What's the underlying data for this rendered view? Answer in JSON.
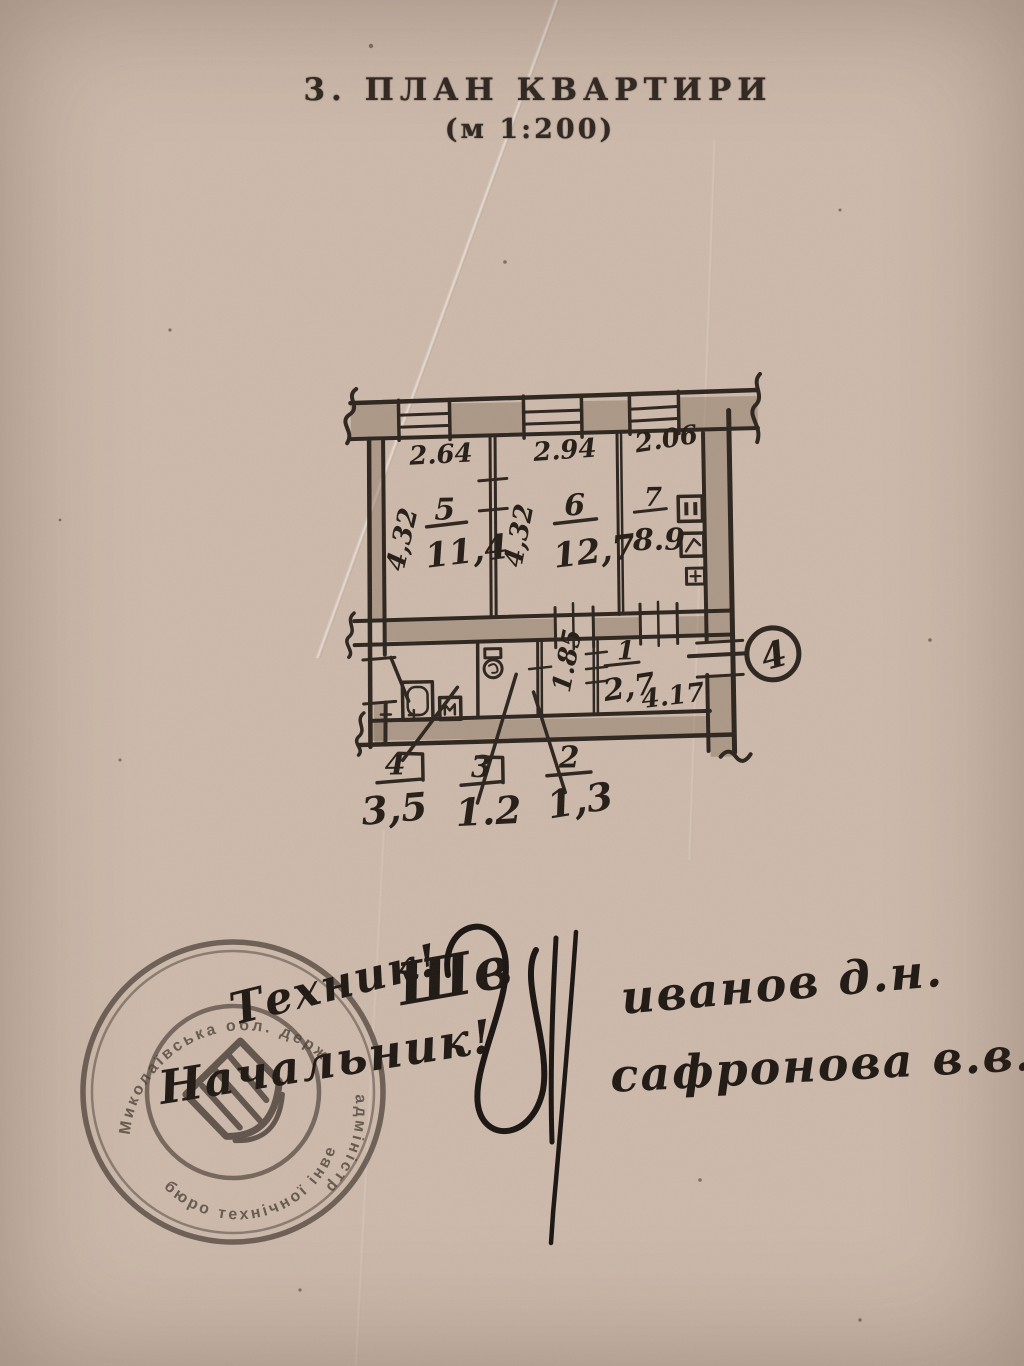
{
  "page": {
    "title": "3.  ПЛАН  КВАРТИРИ",
    "scale": "(м  1:200)"
  },
  "plan": {
    "top_dims": [
      "2.64",
      "2.94",
      "2.06"
    ],
    "rooms": [
      {
        "num": "5",
        "area": "11,4",
        "height_dim": "4,32"
      },
      {
        "num": "6",
        "area": "12,7",
        "height_dim": "4,32"
      },
      {
        "num": "7",
        "area": "8.9"
      },
      {
        "num": "1",
        "area": "2,7",
        "height_dim": "1.85"
      }
    ],
    "bottom_dim": "4.17",
    "balcony_mark": "4",
    "callouts": [
      {
        "num": "4",
        "area": "3,5"
      },
      {
        "num": "3",
        "area": "1.2"
      },
      {
        "num": "2",
        "area": "1,3"
      }
    ]
  },
  "stamp": {
    "ring_top": "Миколаївська обл. держ",
    "ring_right": "адміністр",
    "ring_bottom": "бюро технічної інвентар"
  },
  "handwriting": {
    "role1": "Техник!",
    "role2": "Начальник!",
    "sig_initials": "Шв",
    "name1": "иванов д.н.",
    "name2": "сафронова в.в."
  },
  "colors": {
    "paper": "#d3c0b1",
    "ink": "#2a231d"
  }
}
